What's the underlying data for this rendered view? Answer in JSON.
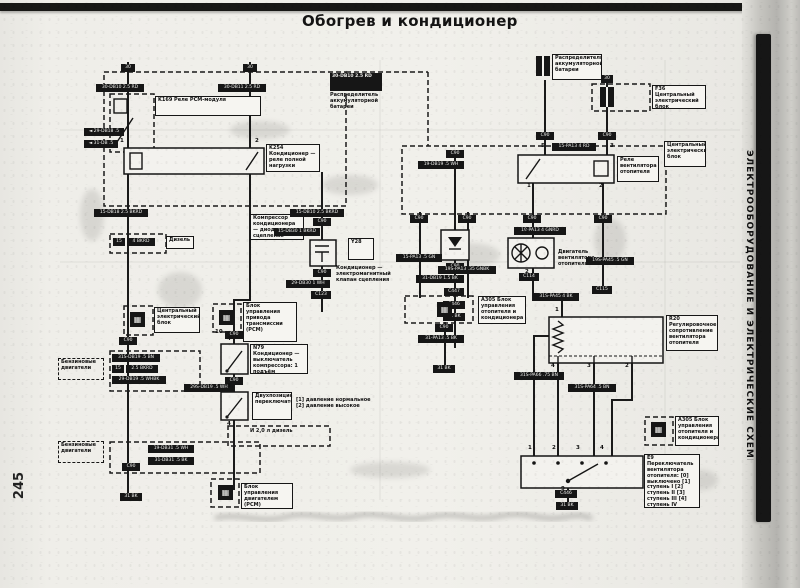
{
  "page": {
    "title": "Обогрев и кондиционер",
    "page_number": "245",
    "side_tab": "ЭЛЕКТРООБОРУДОВАНИЕ И ЭЛЕКТРИЧЕСКИЕ СХЕМЫ"
  },
  "colors": {
    "ink": "#1a1a1a",
    "paper": "#efeee9",
    "binder_bar": "#161616",
    "page_edge": "#c2c1bd"
  },
  "diagram": {
    "boxes": [
      {
        "n": "relay-pcm-label",
        "s": "label",
        "x": 155,
        "y": 96,
        "w": 106,
        "h": 20,
        "t": "K169  Реле PCM-модуля"
      },
      {
        "n": "battery-distributor-left-header",
        "s": "black",
        "x": 330,
        "y": 73,
        "w": 52,
        "h": 18,
        "t": "30-DB10 2.5 RD"
      },
      {
        "n": "battery-distributor-left-label",
        "s": "plain",
        "x": 330,
        "y": 93,
        "w": 56,
        "h": 28,
        "t": "Распределитель аккумуляторной батареи"
      },
      {
        "n": "ac-full-load-relay-label",
        "s": "label",
        "x": 266,
        "y": 144,
        "w": 54,
        "h": 28,
        "t": "K254  Кондиционер — реле полной нагрузки"
      },
      {
        "n": "compressor-diode-label",
        "s": "label",
        "x": 250,
        "y": 214,
        "w": 54,
        "h": 26,
        "t": "Компрессор кондиционера — диод сцепления"
      },
      {
        "n": "diesel-label",
        "s": "label",
        "x": 166,
        "y": 236,
        "w": 28,
        "h": 13,
        "t": "Дизель"
      },
      {
        "n": "y28-code-label",
        "s": "label",
        "x": 348,
        "y": 238,
        "w": 26,
        "h": 22,
        "t": "Y28"
      },
      {
        "n": "y28-valve-label",
        "s": "plain",
        "x": 336,
        "y": 266,
        "w": 54,
        "h": 26,
        "t": "Кондиционер — электромагнитный клапан сцепления"
      },
      {
        "n": "cec-left-label",
        "s": "label",
        "x": 154,
        "y": 307,
        "w": 46,
        "h": 26,
        "t": "Центральный электрический блок"
      },
      {
        "n": "pcm-transmission-label",
        "s": "label",
        "x": 243,
        "y": 302,
        "w": 54,
        "h": 40,
        "t": "Блок управления привода трансмиссии (PCM)"
      },
      {
        "n": "compressor-switch-label",
        "s": "label",
        "x": 250,
        "y": 344,
        "w": 58,
        "h": 30,
        "t": "N79  Кондиционер — выключатель компрессора: 1 подъём давления, 2 спад давления"
      },
      {
        "n": "petrol-engines-label-1",
        "s": "dashedlabel",
        "x": 58,
        "y": 358,
        "w": 46,
        "h": 22,
        "t": "Бензиновые двигатели"
      },
      {
        "n": "petrol-engines-label-2",
        "s": "dashedlabel",
        "x": 58,
        "y": 441,
        "w": 46,
        "h": 22,
        "t": "Бензиновые двигатели"
      },
      {
        "n": "two-position-switch-label",
        "s": "label",
        "x": 252,
        "y": 392,
        "w": 40,
        "h": 28,
        "t": "Двухпозиционный переключатель"
      },
      {
        "n": "pressure-legend",
        "s": "plain",
        "x": 296,
        "y": 398,
        "w": 82,
        "h": 16,
        "t": "[1] давление нормальное  [2] давление высокое"
      },
      {
        "n": "diesel-note",
        "s": "plain",
        "x": 250,
        "y": 429,
        "w": 44,
        "h": 12,
        "t": "И 2,0 л дизель"
      },
      {
        "n": "pcm-engine-label",
        "s": "label",
        "x": 241,
        "y": 483,
        "w": 52,
        "h": 26,
        "t": "Блок управления двигателем (PCM)"
      },
      {
        "n": "battery-distributor-right-label",
        "s": "label",
        "x": 552,
        "y": 54,
        "w": 50,
        "h": 26,
        "t": "Распределитель аккумуляторной батареи"
      },
      {
        "n": "cec-f36-label",
        "s": "label",
        "x": 652,
        "y": 85,
        "w": 54,
        "h": 24,
        "t": "F36  Центральный электрический блок"
      },
      {
        "n": "cec-right-label",
        "s": "label",
        "x": 664,
        "y": 141,
        "w": 42,
        "h": 26,
        "t": "Центральный электрический блок"
      },
      {
        "n": "heater-fan-relay-label",
        "s": "label",
        "x": 617,
        "y": 156,
        "w": 42,
        "h": 26,
        "t": "Реле вентилятора отопителя"
      },
      {
        "n": "fan-motor-label",
        "s": "plain",
        "x": 558,
        "y": 250,
        "w": 48,
        "h": 28,
        "t": "Двигатель вентилятора отопителя"
      },
      {
        "n": "a305-mid-label",
        "s": "label",
        "x": 478,
        "y": 296,
        "w": 48,
        "h": 28,
        "t": "A305  Блок управления отопителя и кондиционера"
      },
      {
        "n": "r20-resistor-label",
        "s": "label",
        "x": 666,
        "y": 315,
        "w": 52,
        "h": 36,
        "t": "R20  Регулировочное сопротивление вентилятора отопителя"
      },
      {
        "n": "a305-bottom-label",
        "s": "label",
        "x": 675,
        "y": 416,
        "w": 44,
        "h": 30,
        "t": "A305  Блок управления отопителя и кондиционера"
      },
      {
        "n": "fan-switch-label",
        "s": "label",
        "x": 644,
        "y": 454,
        "w": 56,
        "h": 54,
        "t": "E9  Переключатель вентилятора отопителя: [0] выключено [1] ступень I [2] ступень II [3] ступень III [4] ступень IV"
      }
    ],
    "chips": [
      {
        "t": "30",
        "x": 121,
        "y": 64,
        "w": 14
      },
      {
        "t": "30",
        "x": 243,
        "y": 64,
        "w": 14
      },
      {
        "t": "30-DB10 2.5 RD",
        "x": 96,
        "y": 84,
        "w": 48
      },
      {
        "t": "30-DB11 2.5 RD",
        "x": 218,
        "y": 84,
        "w": 48
      },
      {
        "t": "◄ 29-DB18 .5",
        "x": 84,
        "y": 128,
        "w": 40
      },
      {
        "t": "◄ 31-DB .5",
        "x": 84,
        "y": 140,
        "w": 34
      },
      {
        "t": "15-DB18 2.5 BKRD",
        "x": 94,
        "y": 209,
        "w": 54
      },
      {
        "t": "15-DB10 2.5 BKRD",
        "x": 290,
        "y": 209,
        "w": 54
      },
      {
        "t": "15",
        "x": 113,
        "y": 238,
        "w": 12
      },
      {
        "t": "4 BKRD",
        "x": 127,
        "y": 238,
        "w": 28
      },
      {
        "t": "C90",
        "x": 313,
        "y": 218,
        "w": 18
      },
      {
        "t": "15-DB30 1 BKRD",
        "x": 274,
        "y": 228,
        "w": 46
      },
      {
        "t": "C90",
        "x": 313,
        "y": 269,
        "w": 18
      },
      {
        "t": "29-DB30 1 WH",
        "x": 286,
        "y": 280,
        "w": 44
      },
      {
        "t": "C123",
        "x": 311,
        "y": 291,
        "w": 20
      },
      {
        "t": "C90",
        "x": 446,
        "y": 150,
        "w": 18
      },
      {
        "t": "19-DB19 .5 WH",
        "x": 418,
        "y": 161,
        "w": 46
      },
      {
        "t": "C90",
        "x": 446,
        "y": 263,
        "w": 18
      },
      {
        "t": "31-DB19 1.5 BK",
        "x": 416,
        "y": 275,
        "w": 48
      },
      {
        "t": "C447",
        "x": 444,
        "y": 288,
        "w": 20
      },
      {
        "t": "C446",
        "x": 443,
        "y": 301,
        "w": 22
      },
      {
        "t": "31 BK",
        "x": 443,
        "y": 313,
        "w": 22
      },
      {
        "t": "C90",
        "x": 225,
        "y": 331,
        "w": 18
      },
      {
        "t": "C90",
        "x": 225,
        "y": 377,
        "w": 18
      },
      {
        "t": "29S-DB19 .5 WH",
        "x": 184,
        "y": 384,
        "w": 50
      },
      {
        "t": "C90",
        "x": 119,
        "y": 337,
        "w": 18
      },
      {
        "t": "31S-DB19 .5 BN",
        "x": 112,
        "y": 354,
        "w": 48
      },
      {
        "t": "15",
        "x": 112,
        "y": 365,
        "w": 12
      },
      {
        "t": "2.5 BKRD",
        "x": 126,
        "y": 365,
        "w": 32
      },
      {
        "t": "29-DB19 .5 WHBK",
        "x": 112,
        "y": 376,
        "w": 54
      },
      {
        "t": "19-DB31 .5 WH",
        "x": 148,
        "y": 445,
        "w": 46
      },
      {
        "t": "31-DB31 .5 BK",
        "x": 148,
        "y": 457,
        "w": 46
      },
      {
        "t": "C90",
        "x": 122,
        "y": 463,
        "w": 18
      },
      {
        "t": "31 BK",
        "x": 120,
        "y": 493,
        "w": 22
      },
      {
        "t": "C90",
        "x": 536,
        "y": 132,
        "w": 18
      },
      {
        "t": "C90",
        "x": 598,
        "y": 132,
        "w": 18
      },
      {
        "t": "15-PA13 4 RD",
        "x": 552,
        "y": 143,
        "w": 44
      },
      {
        "t": "30",
        "x": 601,
        "y": 75,
        "w": 12
      },
      {
        "t": "C90",
        "x": 410,
        "y": 215,
        "w": 18
      },
      {
        "t": "15-PA13 .5 GN",
        "x": 396,
        "y": 254,
        "w": 46
      },
      {
        "t": "C90",
        "x": 458,
        "y": 215,
        "w": 18
      },
      {
        "t": "19S-PA13 .35 GNBK",
        "x": 438,
        "y": 266,
        "w": 58
      },
      {
        "t": "C90",
        "x": 523,
        "y": 215,
        "w": 18
      },
      {
        "t": "19-PA13 4 GNRD",
        "x": 514,
        "y": 227,
        "w": 52
      },
      {
        "t": "C90",
        "x": 594,
        "y": 215,
        "w": 18
      },
      {
        "t": "19S-PA45 .5 GN",
        "x": 586,
        "y": 257,
        "w": 48
      },
      {
        "t": "C115",
        "x": 592,
        "y": 286,
        "w": 20
      },
      {
        "t": "C114",
        "x": 519,
        "y": 273,
        "w": 20
      },
      {
        "t": "31S-PA45 4 BK",
        "x": 533,
        "y": 293,
        "w": 46
      },
      {
        "t": "C90",
        "x": 435,
        "y": 324,
        "w": 18
      },
      {
        "t": "31-PA13 .5 BK",
        "x": 418,
        "y": 335,
        "w": 46
      },
      {
        "t": "31 BK",
        "x": 433,
        "y": 365,
        "w": 22
      },
      {
        "t": "31S-PA66 .75 BN",
        "x": 514,
        "y": 372,
        "w": 50
      },
      {
        "t": "31S-PA64 .5 BN",
        "x": 568,
        "y": 384,
        "w": 48
      },
      {
        "t": "C446",
        "x": 555,
        "y": 490,
        "w": 22
      },
      {
        "t": "31 BK",
        "x": 556,
        "y": 502,
        "w": 22
      },
      {
        "s": "num",
        "t": "1",
        "x": 119,
        "y": 139
      },
      {
        "s": "num",
        "t": "2",
        "x": 254,
        "y": 139
      },
      {
        "s": "num",
        "t": "1",
        "x": 526,
        "y": 184
      },
      {
        "s": "num",
        "t": "2",
        "x": 598,
        "y": 184
      },
      {
        "s": "num",
        "t": "5",
        "x": 540,
        "y": 144
      },
      {
        "s": "num",
        "t": "3",
        "x": 609,
        "y": 144
      },
      {
        "s": "num",
        "t": "1",
        "x": 524,
        "y": 230
      },
      {
        "s": "num",
        "t": "2",
        "x": 524,
        "y": 270
      },
      {
        "s": "num",
        "t": "1",
        "x": 554,
        "y": 308
      },
      {
        "s": "num",
        "t": "4",
        "x": 550,
        "y": 364
      },
      {
        "s": "num",
        "t": "3",
        "x": 586,
        "y": 364
      },
      {
        "s": "num",
        "t": "2",
        "x": 624,
        "y": 364
      },
      {
        "s": "num",
        "t": "1",
        "x": 527,
        "y": 446
      },
      {
        "s": "num",
        "t": "2",
        "x": 551,
        "y": 446
      },
      {
        "s": "num",
        "t": "3",
        "x": 575,
        "y": 446
      },
      {
        "s": "num",
        "t": "4",
        "x": 599,
        "y": 446
      },
      {
        "s": "num",
        "t": "9",
        "x": 560,
        "y": 487
      },
      {
        "s": "num",
        "t": "10",
        "x": 214,
        "y": 330
      },
      {
        "s": "num",
        "t": "4",
        "x": 226,
        "y": 337
      },
      {
        "s": "num",
        "t": "3",
        "x": 226,
        "y": 384
      },
      {
        "s": "num",
        "t": "4",
        "x": 226,
        "y": 422
      },
      {
        "s": "icon",
        "n": "cec-left-icon",
        "t": "▦",
        "x": 130,
        "y": 312
      },
      {
        "s": "icon",
        "n": "pcm-transmission-icon",
        "t": "▦",
        "x": 219,
        "y": 310
      },
      {
        "s": "icon",
        "n": "pcm-engine-icon",
        "t": "▦",
        "x": 218,
        "y": 485
      },
      {
        "s": "icon",
        "n": "a305-mid-icon",
        "t": "▦",
        "x": 437,
        "y": 302
      },
      {
        "s": "icon",
        "n": "a305-bottom-icon",
        "t": "▦",
        "x": 651,
        "y": 422
      },
      {
        "s": "fuse",
        "n": "battery-distributor-fuse",
        "t": "",
        "x": 536,
        "y": 56
      },
      {
        "s": "fuse",
        "n": "fuse-f36",
        "t": "",
        "x": 600,
        "y": 87
      }
    ]
  }
}
